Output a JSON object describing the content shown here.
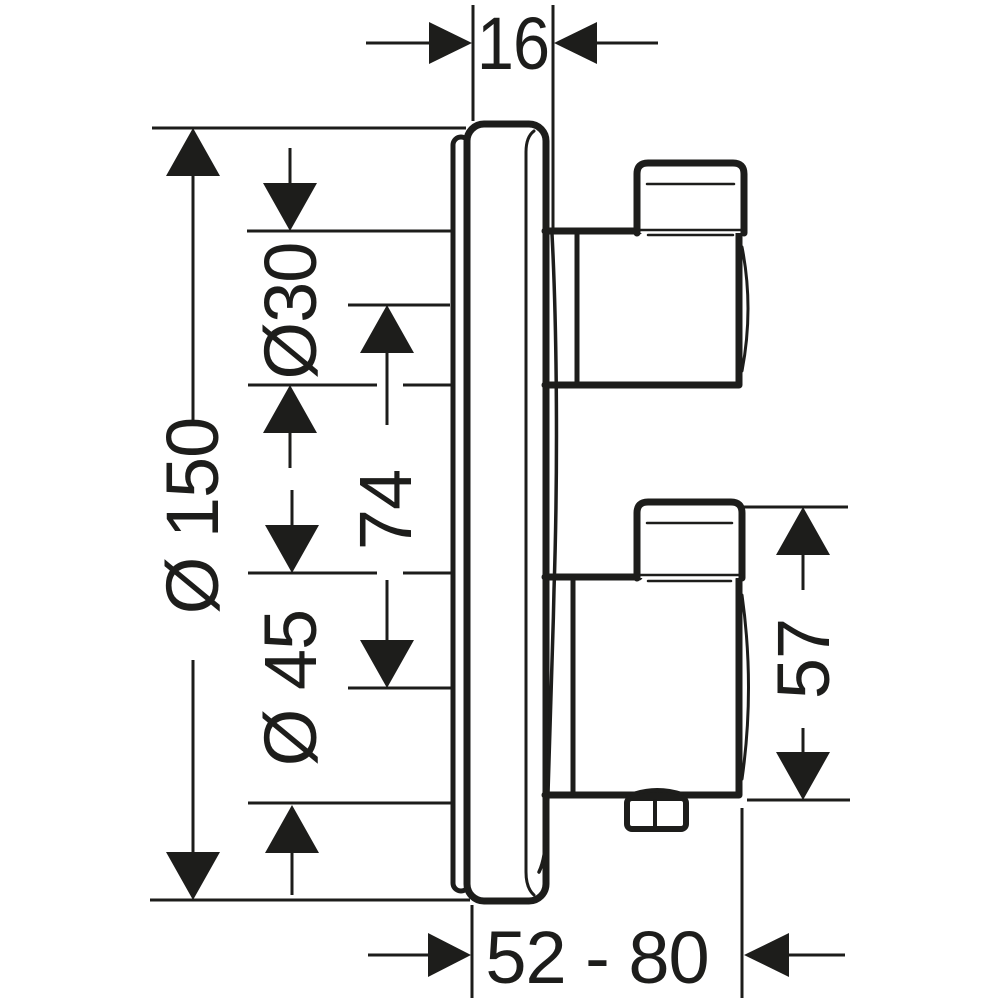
{
  "page": {
    "background": "#ffffff"
  },
  "drawing": {
    "line_color": "#1d1d1b",
    "dimensions": {
      "plate_thickness": "16",
      "escutcheon_diameter": "Ø 150",
      "upper_handle_diameter": "Ø30",
      "handle_axis_spacing": "74",
      "lower_handle_diameter": "Ø 45",
      "lower_handle_depth": "57",
      "installation_depth_range": "52 - 80"
    }
  }
}
